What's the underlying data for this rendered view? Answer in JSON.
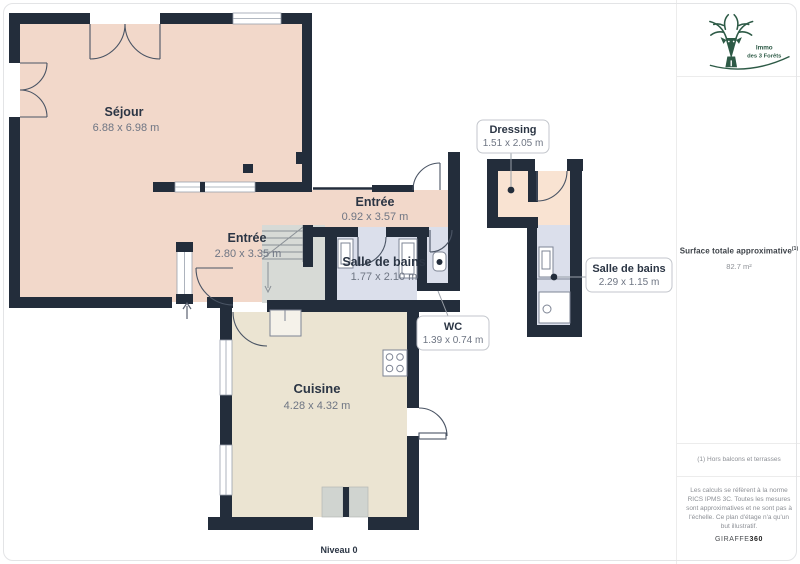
{
  "page": {
    "level_label": "Niveau 0"
  },
  "rooms": {
    "sejour": {
      "name": "Séjour",
      "dims": "6.88 x 6.98 m"
    },
    "entree_main": {
      "name": "Entrée",
      "dims": "2.80 x 3.35 m"
    },
    "entree_corridor": {
      "name": "Entrée",
      "dims": "0.92 x 3.57 m"
    },
    "salle_de_bains": {
      "name": "Salle de bains",
      "dims": "1.77 x 2.10 m"
    },
    "wc": {
      "name": "WC",
      "dims": "1.39 x 0.74 m"
    },
    "cuisine": {
      "name": "Cuisine",
      "dims": "4.28 x 4.32 m"
    },
    "dressing": {
      "name": "Dressing",
      "dims": "1.51 x 2.05 m"
    },
    "salle_de_bains_2": {
      "name": "Salle de bains",
      "dims": "2.29 x 1.15 m"
    }
  },
  "sidebar": {
    "brand_line1": "Immo",
    "brand_line2": "des 3 Forêts",
    "surface_title": "Surface totale approximative",
    "surface_superscript": "(1)",
    "surface_value": "82.7 m²",
    "footnote": "(1) Hors balcons et terrasses",
    "disclaimer": "Les calculs se réfèrent à la norme RICS IPMS 3C. Toutes les mesures sont approximatives et ne sont pas à l'échelle. Ce plan d'étage n'a qu'un but illustratif.",
    "brand_footer_regular": "GIRAFFE",
    "brand_footer_bold": "360"
  },
  "colors": {
    "wall": "#232d3b",
    "sejour_fill": "#f2d8ca",
    "dressing_fill": "#f9e3d2",
    "bathroom_fill": "#dbdfeb",
    "cuisine_fill": "#ebe4d2",
    "stairs_fill": "#d7dad6",
    "logo_green": "#2d5a46"
  }
}
